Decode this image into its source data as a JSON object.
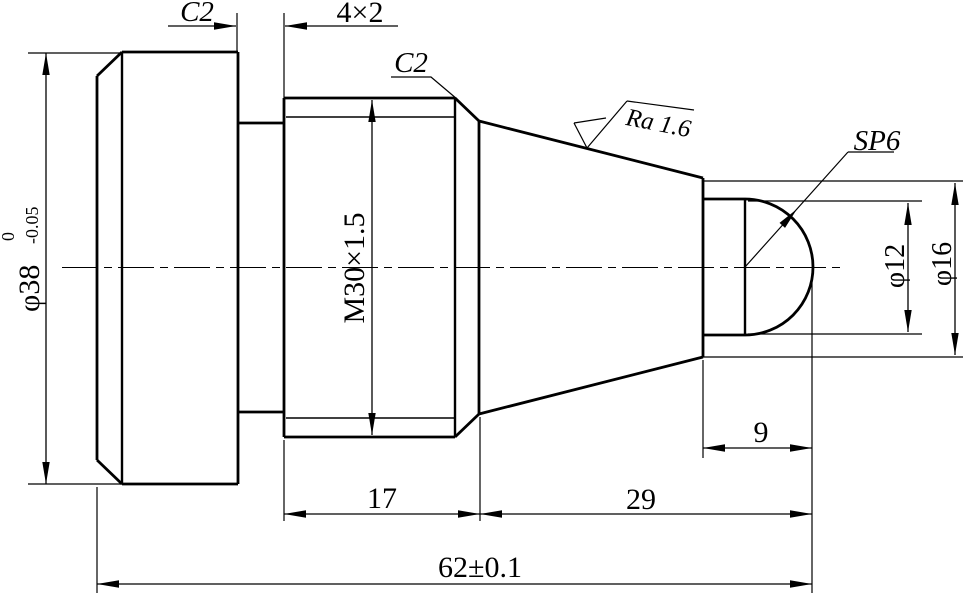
{
  "drawing": {
    "type": "engineering-part-drawing",
    "background": "#ffffff",
    "line_color": "#000000",
    "annotations": {
      "chamfer_flange": "C2",
      "groove": "4×2",
      "chamfer_thread": "C2",
      "surface_roughness": "Ra 1.6",
      "sphere_label": "SP6"
    },
    "diameters": {
      "d38": {
        "text": "φ38",
        "tol_upper": "0",
        "tol_lower": "-0.05"
      },
      "thread": "M30×1.5",
      "d12": "φ12",
      "d16": "φ16"
    },
    "lengths": {
      "l17": "17",
      "l29": "29",
      "l9": "9",
      "l62": "62±0.1"
    }
  }
}
